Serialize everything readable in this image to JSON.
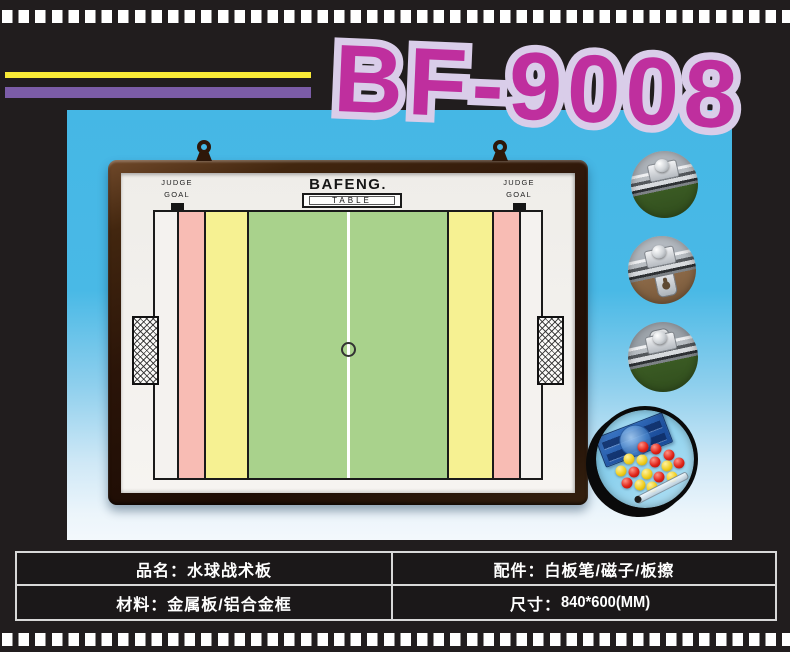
{
  "product": {
    "model": "BF-9008"
  },
  "board": {
    "brand": "BAFENG",
    "brand_suffix": ".",
    "table_label": "TABLE",
    "judge_goal": {
      "line1": "JUDGE",
      "line2": "GOAL"
    }
  },
  "spec_table": {
    "rows": [
      {
        "left_label": "品名：",
        "left_value": "水球战术板",
        "right_label": "配件：",
        "right_value": "白板笔/磁子/板擦"
      },
      {
        "left_label": "材料：",
        "left_value": "金属板/铝合金框",
        "right_label": "尺寸：",
        "right_value": "840*600(MM)"
      }
    ]
  },
  "accessories_photo": {
    "magnets": [
      {
        "x": 47,
        "y": 37,
        "color": "red"
      },
      {
        "x": 60,
        "y": 39,
        "color": "red"
      },
      {
        "x": 73,
        "y": 45,
        "color": "red"
      },
      {
        "x": 33,
        "y": 49,
        "color": "yellow"
      },
      {
        "x": 46,
        "y": 50,
        "color": "yellow"
      },
      {
        "x": 59,
        "y": 52,
        "color": "red"
      },
      {
        "x": 71,
        "y": 56,
        "color": "yellow"
      },
      {
        "x": 83,
        "y": 53,
        "color": "red"
      },
      {
        "x": 25,
        "y": 61,
        "color": "yellow"
      },
      {
        "x": 38,
        "y": 62,
        "color": "red"
      },
      {
        "x": 51,
        "y": 64,
        "color": "yellow"
      },
      {
        "x": 63,
        "y": 67,
        "color": "red"
      },
      {
        "x": 76,
        "y": 67,
        "color": "yellow"
      },
      {
        "x": 31,
        "y": 73,
        "color": "red"
      },
      {
        "x": 44,
        "y": 75,
        "color": "yellow"
      },
      {
        "x": 56,
        "y": 77,
        "color": "yellow"
      }
    ]
  },
  "colors": {
    "model_fill": "#bf2f9e",
    "model_outline": "#d9cde9",
    "stripe_yellow": "#f8ea37",
    "stripe_purple": "#7b5ca7",
    "sky_blue": "#45b7e5",
    "court_green": "#a9d28c",
    "court_yellow": "#f6f192",
    "court_pink": "#f8bcb4",
    "film_black": "#211d1e",
    "table_border": "#d8d8d8",
    "magnet_red": "#e02318",
    "magnet_yellow": "#f0cd1e"
  }
}
